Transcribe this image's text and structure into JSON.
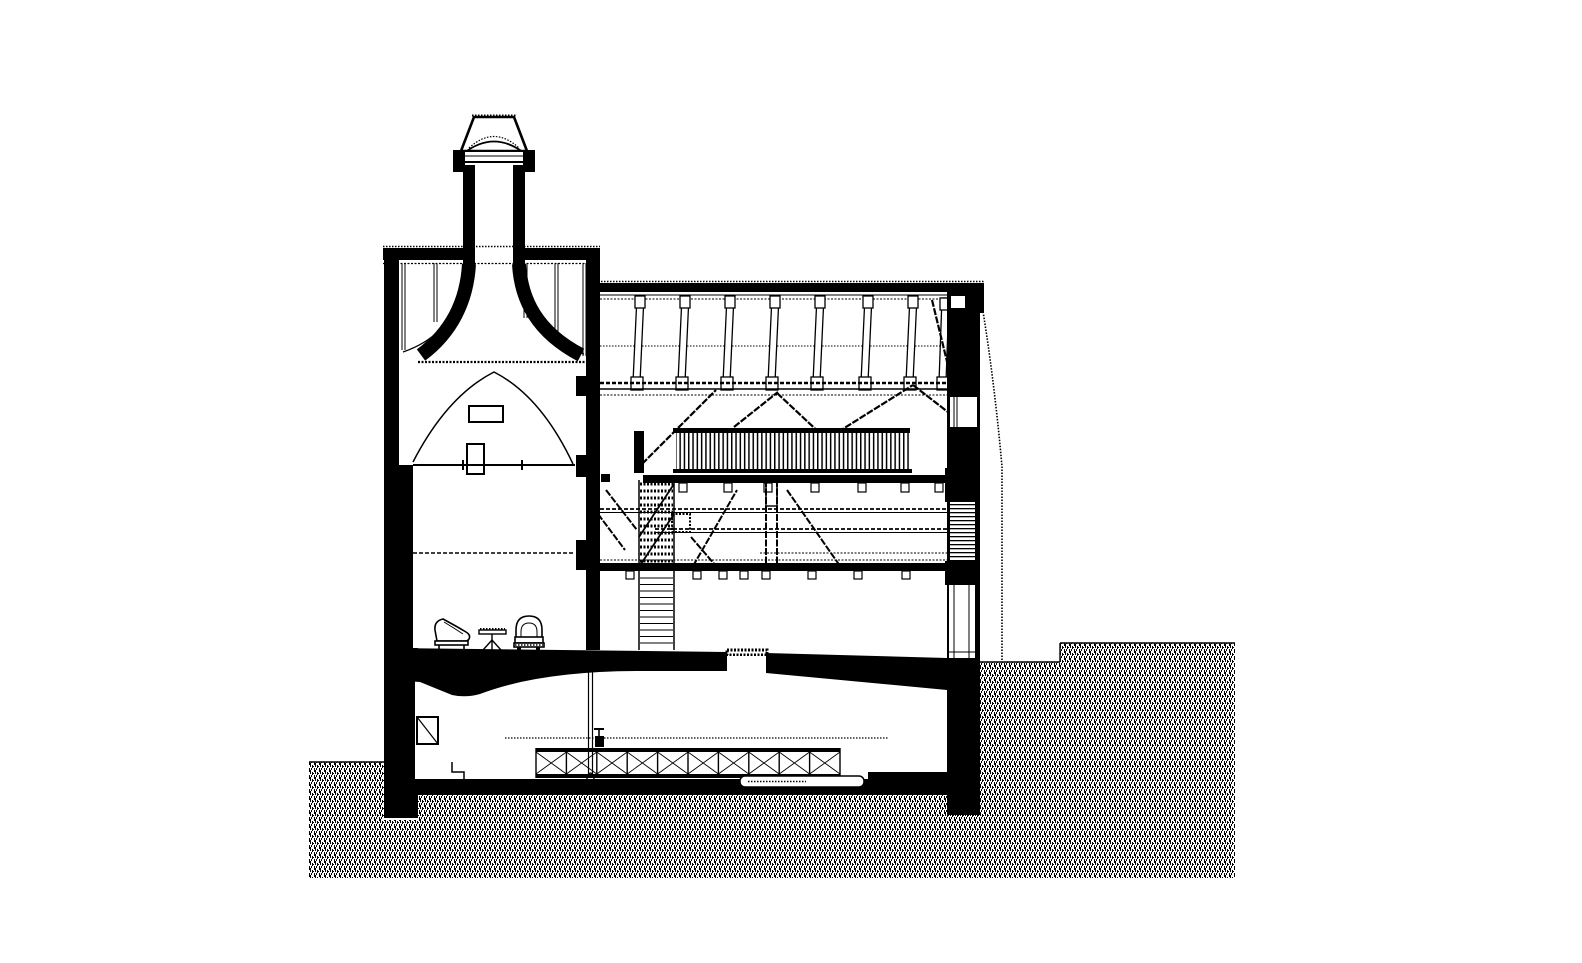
{
  "figure": {
    "type": "architectural-cross-section",
    "subject": "Black-ink sectional drawing of a kiln (oast) building: tapered chimney with cowl over a vaulted kiln chamber furnished with two armchairs and a side table, adjoining three-level hall with inclined roof posts, trussed tie beam, slatted gallery balustrade, two-flight staircase, ground-floor slab with opening, basement containing an X-braced rack, standpipe and low platform, and surrounding earth drawn as grey stipple hatch",
    "width_px": 1582,
    "height_px": 963
  },
  "colors": {
    "ink": "#000000",
    "paper": "#ffffff"
  },
  "parts": [
    "chimney-cowl",
    "chimney-stack",
    "kiln-roof-band",
    "kiln-vent-slats",
    "kiln-vault",
    "kiln-chamber-arch",
    "kiln-wall-opening-upper",
    "kiln-wall-opening-lower",
    "kiln-drying-floor-line",
    "kiln-mid-floor-line",
    "armchair-left",
    "side-table",
    "armchair-right",
    "roof-eaves-band",
    "roof-posts",
    "tie-beam",
    "truss-braces",
    "gallery-balustrade",
    "gallery-floor",
    "middle-floor",
    "hall-braces",
    "staircase-upper-flight",
    "staircase-lower-flight",
    "stair-side-box",
    "right-wall",
    "right-wall-upper-window",
    "right-wall-louver",
    "right-wall-lower-window",
    "ground-floor-slab",
    "floor-opening",
    "basement",
    "basement-niche",
    "basement-steps",
    "standpipe",
    "x-braced-rack",
    "low-platform",
    "basement-slab",
    "footings",
    "far-roof-edge-line",
    "ground-hatch-left",
    "ground-hatch-bottom",
    "ground-hatch-right"
  ]
}
